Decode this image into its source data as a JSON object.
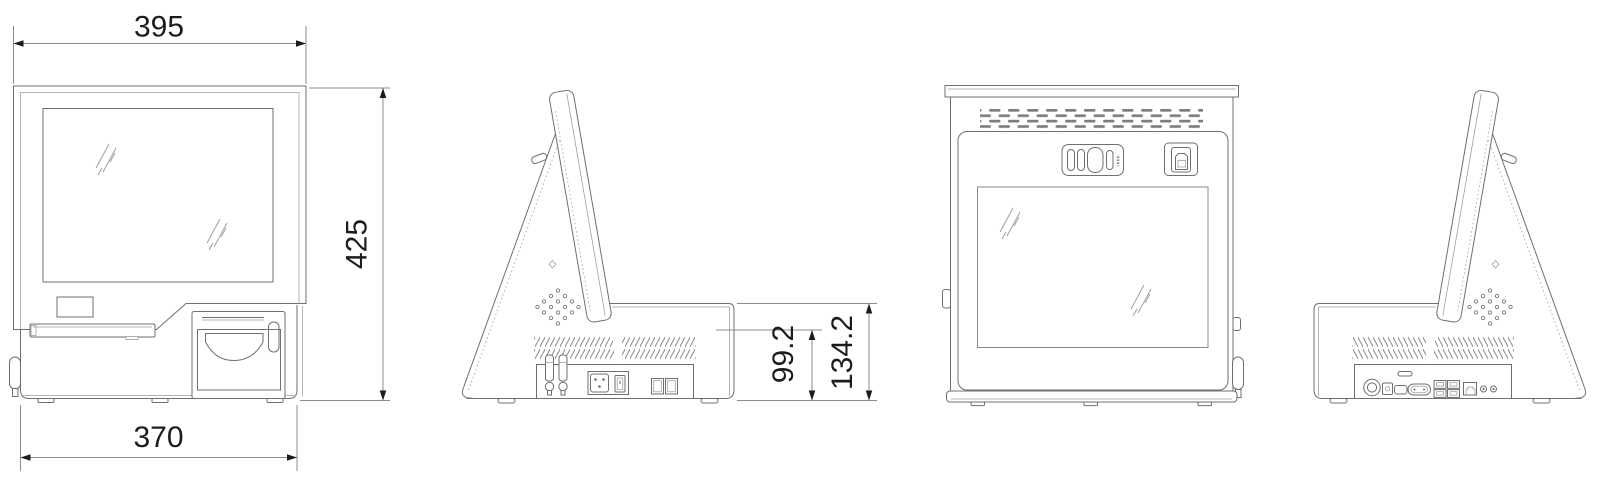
{
  "drawing": {
    "type": "technical-dimension-drawing",
    "background": "#ffffff",
    "line_color": "#6f6f6f",
    "dim_line_color": "#8c8c8c",
    "dim_text_color": "#1c1c1c",
    "dimensions": {
      "front_width": "395",
      "overall_height": "425",
      "base_width": "370",
      "base_height": "99.2",
      "shelf_height": "134.2"
    }
  }
}
